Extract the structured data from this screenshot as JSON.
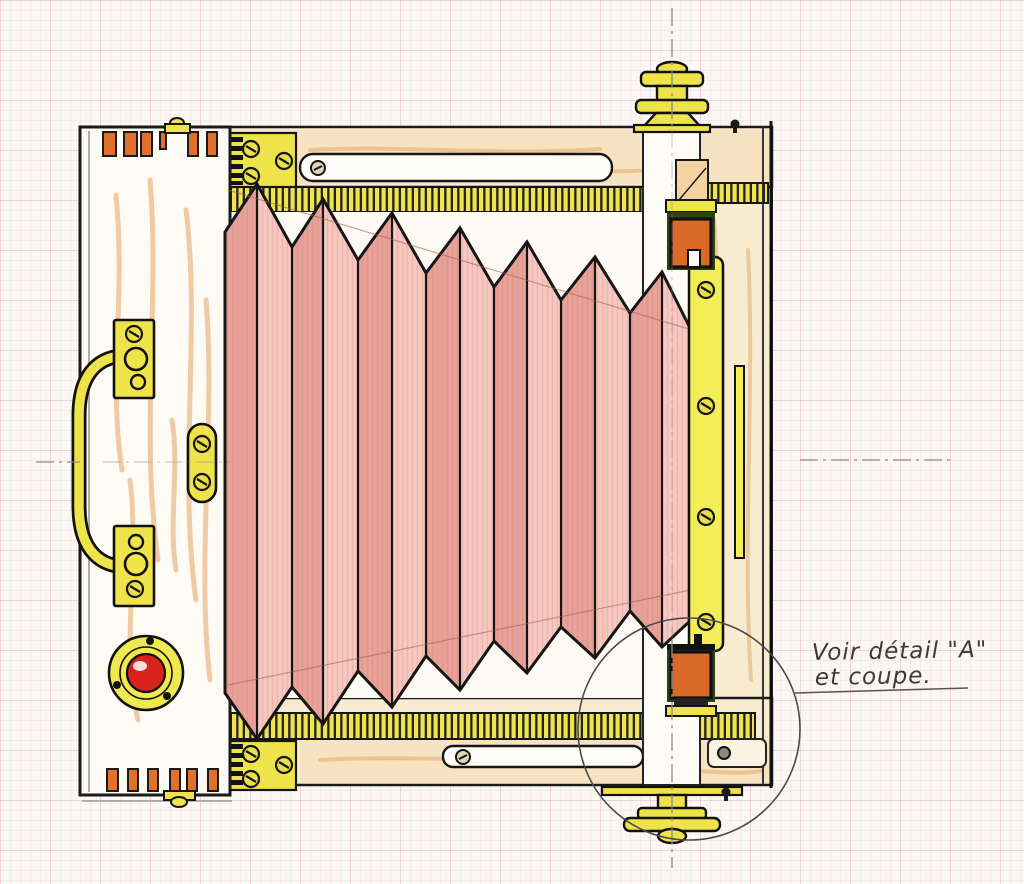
{
  "artwork": {
    "kind": "hand-coloured technical drawing on graph paper",
    "subject": "folding bellows camera, side elevation"
  },
  "annotation": {
    "line1": "Voir détail \"A\"",
    "line2": "et coupe."
  },
  "colors": {
    "paper": "#fbf8f4",
    "grid_line": "#db8db4",
    "outline": "#1a1a1a",
    "brass": "#eee34a",
    "wood_light": "#f8ecd0",
    "wood_grain": "#e0873a",
    "bellows_light": "#f6c9c0",
    "bellows_dark": "#e49a90",
    "button_red": "#d8231c",
    "clamp_orange": "#d96a28",
    "clamp_green": "#31451a",
    "centerline": "#8a8a8a"
  },
  "parts": [
    "rear-panel",
    "dovetail-joints",
    "carry-handle",
    "latch-keeper-plate",
    "shutter-release-button",
    "bellows",
    "top-rack-rail",
    "bottom-rack-rail",
    "focus-knob-top",
    "focus-knob-bottom",
    "front-standard",
    "clamp-top",
    "clamp-bottom",
    "lens-board-edge",
    "detail-callout-circle"
  ]
}
